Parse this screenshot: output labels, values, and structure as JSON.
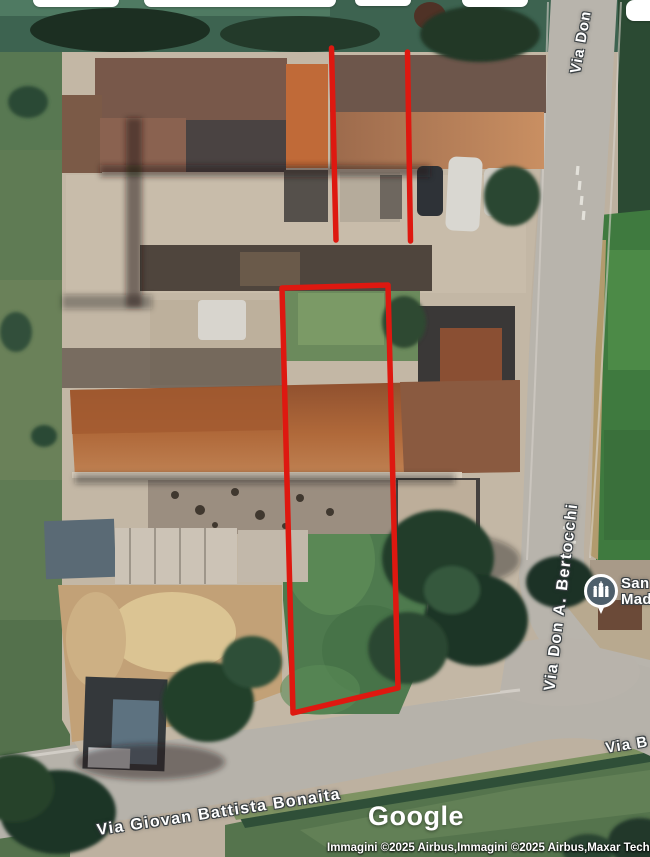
{
  "colors": {
    "overlay_red": "#de1810",
    "poi_marker_bg": "#4e5f6b",
    "label_halo": "#3a4043"
  },
  "map": {
    "street_labels": [
      {
        "text": "Via Don"
      },
      {
        "text": "Via Don A. Bertocchi"
      },
      {
        "text": "Via Giovan Battista Bonaita"
      },
      {
        "text": "Via B"
      }
    ],
    "poi": {
      "icon": "church-icon",
      "name_line1": "San",
      "name_line2": "Mad"
    }
  },
  "branding": {
    "logo_text": "Google"
  },
  "attribution": {
    "text": "Immagini ©2025 Airbus,Immagini ©2025 Airbus,Maxar Techn"
  }
}
